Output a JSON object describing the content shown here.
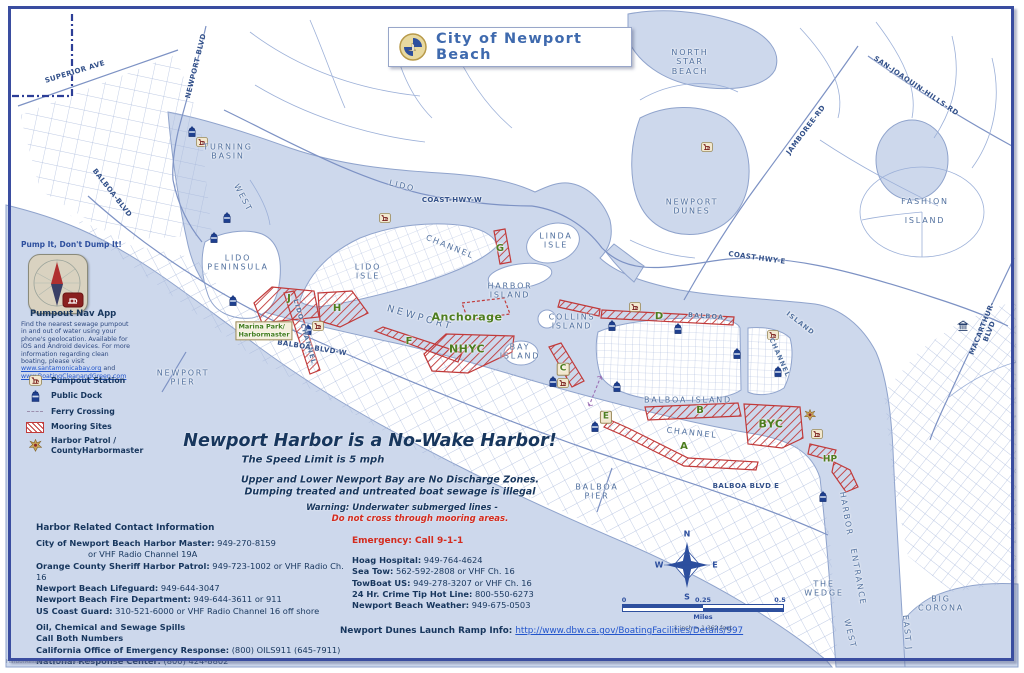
{
  "title": {
    "text": "City of Newport Beach"
  },
  "sidebar": {
    "slogan": "Pump It, Don't Dump It!",
    "app_name": "Pumpout Nav App",
    "desc": "Find the nearest sewage pumpout in and out of water using your phone's geolocation. Available for iOS and Android devices. For more information regarding clean boating, please visit",
    "link1": "www.santamonicabay.org",
    "conj": " and ",
    "link2": "www.BoatingCleanandGreen.com"
  },
  "legend": {
    "items": [
      {
        "icon": "pumpout",
        "label": "Pumpout Station"
      },
      {
        "icon": "dock",
        "label": "Public Dock"
      },
      {
        "icon": "ferry",
        "label": "Ferry Crossing"
      },
      {
        "icon": "mooring",
        "label": "Mooring Sites"
      },
      {
        "icon": "star",
        "label": "Harbor Patrol /\nCountyHarbormaster"
      }
    ]
  },
  "notices": {
    "main": "Newport Harbor is a No-Wake Harbor!",
    "speed": "The Speed Limit is 5 mph",
    "discharge1": "Upper and Lower Newport Bay are No Discharge Zones.",
    "discharge2": "Dumping treated and untreated boat sewage is illegal",
    "warning1": "Warning: Underwater submerged lines -",
    "warning2": "Do not cross through mooring areas."
  },
  "contacts": {
    "heading": "Harbor Related Contact Information",
    "lines": [
      {
        "b": "City of Newport Beach Harbor Master:",
        "t": " 949-270-8159"
      },
      {
        "t": "or VHF Radio Channel 19A",
        "indent": true
      },
      {
        "b": "Orange County Sheriff Harbor Patrol:",
        "t": " 949-723-1002 or VHF Radio Ch. 16"
      },
      {
        "b": "Newport Beach Lifeguard:",
        "t": " 949-644-3047"
      },
      {
        "b": "Newport Beach Fire Department:",
        "t": " 949-644-3611 or 911"
      },
      {
        "b": "US Coast Guard:",
        "t": " 310-521-6000 or VHF Radio Channel 16 off shore"
      },
      {
        "b": "Oil, Chemical and Sewage Spills",
        "gap": true
      },
      {
        "b": "Call Both Numbers"
      },
      {
        "b": "California Office of Emergency Response:",
        "t": " (800) OILS911 (645-7911)"
      },
      {
        "b": "National Response Center:",
        "t": " (800) 424-8802"
      }
    ]
  },
  "emergency": {
    "heading_label": "Emergency:",
    "heading_value": " Call 9-1-1",
    "lines": [
      {
        "b": "Hoag Hospital:",
        "t": " 949-764-4624"
      },
      {
        "b": "Sea Tow:",
        "t": " 562-592-2808 or VHF Ch. 16"
      },
      {
        "b": "TowBoat US:",
        "t": " 949-278-3207 or VHF Ch. 16"
      },
      {
        "b": "24 Hr. Crime Tip Hot Line:",
        "t": " 800-550-6273"
      },
      {
        "b": "Newport Beach Weather:",
        "t": " 949-675-0503"
      }
    ]
  },
  "launch": {
    "label": "Newport Dunes Launch Ramp Info: ",
    "url": "http://www.dbw.ca.gov/BoatingFacilities/Details/997"
  },
  "compass": {
    "n": "N",
    "w": "W",
    "e": "E",
    "s": "S"
  },
  "scale": {
    "t0": "0",
    "t1": "0.25",
    "t2": "0.5",
    "unit": "Miles",
    "note": "1 inch = 1,362 feet"
  },
  "footer": {
    "text": "HarborResources_PubInfo2.mxd"
  },
  "colors": {
    "water": "#cdd8ec",
    "border": "#3a4da0",
    "mooring_red": "#c13a3a",
    "navy": "#17365d",
    "green": "#4d7d1f",
    "alert_red": "#d42b1e",
    "road": "#7d92c4"
  },
  "map": {
    "labels": [
      {
        "t": "SUPERIOR AVE",
        "x": 75,
        "y": 72,
        "r": -17,
        "c": "road"
      },
      {
        "t": "NEWPORT BLVD",
        "x": 196,
        "y": 66,
        "r": -76,
        "c": "road"
      },
      {
        "t": "BALBOA-BLVD",
        "x": 112,
        "y": 193,
        "r": 52,
        "c": "road"
      },
      {
        "t": "TURNING\nBASIN",
        "x": 228,
        "y": 152,
        "r": 0,
        "c": "place"
      },
      {
        "t": "WEST",
        "x": 243,
        "y": 198,
        "r": 62,
        "c": "place"
      },
      {
        "t": "LIDO",
        "x": 402,
        "y": 186,
        "r": 14,
        "c": "place"
      },
      {
        "t": "CHANNEL",
        "x": 450,
        "y": 247,
        "r": 22,
        "c": "place"
      },
      {
        "t": "LIDO\nPENINSULA",
        "x": 238,
        "y": 263,
        "r": 0,
        "c": "place"
      },
      {
        "t": "LIDO\nISLE",
        "x": 368,
        "y": 272,
        "r": 0,
        "c": "place"
      },
      {
        "t": "LIDO CHANNEL",
        "x": 304,
        "y": 332,
        "r": 74,
        "c": "place-sm"
      },
      {
        "t": "COAST-HWY-W",
        "x": 452,
        "y": 200,
        "r": 0,
        "c": "road"
      },
      {
        "t": "LINDA\nISLE",
        "x": 556,
        "y": 241,
        "r": 0,
        "c": "place"
      },
      {
        "t": "HARBOR\nISLAND",
        "x": 510,
        "y": 291,
        "r": 0,
        "c": "place"
      },
      {
        "t": "NEWPORT",
        "x": 420,
        "y": 318,
        "r": 16,
        "c": "place-lg"
      },
      {
        "t": "BAY\nISLAND",
        "x": 520,
        "y": 352,
        "r": 0,
        "c": "place"
      },
      {
        "t": "COLLINS\nISLAND",
        "x": 572,
        "y": 322,
        "r": 0,
        "c": "place"
      },
      {
        "t": "NORTH\nSTAR\nBEACH",
        "x": 690,
        "y": 62,
        "r": 0,
        "c": "place"
      },
      {
        "t": "NEWPORT\nDUNES",
        "x": 692,
        "y": 207,
        "r": 0,
        "c": "place"
      },
      {
        "t": "SAN-JOAQUIN-HILLS-RD",
        "x": 916,
        "y": 86,
        "r": 34,
        "c": "road"
      },
      {
        "t": "JAMBOREE-RD",
        "x": 806,
        "y": 130,
        "r": -53,
        "c": "road"
      },
      {
        "t": "FASHION\n\nISLAND",
        "x": 925,
        "y": 211,
        "r": 0,
        "c": "place"
      },
      {
        "t": "COAST-HWY-E",
        "x": 757,
        "y": 258,
        "r": 8,
        "c": "road"
      },
      {
        "t": "MACARTHUR-BLVD",
        "x": 986,
        "y": 330,
        "r": -68,
        "c": "road"
      },
      {
        "t": "BALBOA",
        "x": 706,
        "y": 317,
        "r": 4,
        "c": "place-sm"
      },
      {
        "t": "ISLAND",
        "x": 800,
        "y": 324,
        "r": 38,
        "c": "place-sm"
      },
      {
        "t": "CHANNEL",
        "x": 779,
        "y": 358,
        "r": 66,
        "c": "place-sm"
      },
      {
        "t": "BALBOA ISLAND",
        "x": 688,
        "y": 400,
        "r": 0,
        "c": "place"
      },
      {
        "t": "CHANNEL",
        "x": 692,
        "y": 433,
        "r": 6,
        "c": "place"
      },
      {
        "t": "BALBOA\nPIER",
        "x": 597,
        "y": 492,
        "r": 0,
        "c": "place"
      },
      {
        "t": "BALBOA BLVD E",
        "x": 746,
        "y": 486,
        "r": 0,
        "c": "road"
      },
      {
        "t": "HARBOR",
        "x": 846,
        "y": 514,
        "r": 80,
        "c": "place"
      },
      {
        "t": "ENTRANCE",
        "x": 858,
        "y": 577,
        "r": 80,
        "c": "place"
      },
      {
        "t": "THE\nWEDGE",
        "x": 824,
        "y": 589,
        "r": 0,
        "c": "place"
      },
      {
        "t": "BIG\nCORONA",
        "x": 941,
        "y": 604,
        "r": 0,
        "c": "place"
      },
      {
        "t": "WEST",
        "x": 850,
        "y": 634,
        "r": 76,
        "c": "place"
      },
      {
        "t": "EAST J",
        "x": 907,
        "y": 633,
        "r": 84,
        "c": "place"
      },
      {
        "t": "NEWPORT\nPIER",
        "x": 183,
        "y": 378,
        "r": 0,
        "c": "place"
      },
      {
        "t": "BALBOA-BLVD-W",
        "x": 312,
        "y": 348,
        "r": 9,
        "c": "road"
      },
      {
        "t": "Marina Park/\nHarbormaster",
        "x": 264,
        "y": 331,
        "r": 0,
        "c": "green-box"
      },
      {
        "t": "Anchorage",
        "x": 467,
        "y": 318,
        "r": 0,
        "c": "green-lg"
      },
      {
        "t": "NHYC",
        "x": 467,
        "y": 350,
        "r": 0,
        "c": "green-lg"
      },
      {
        "t": "BYC",
        "x": 771,
        "y": 425,
        "r": 0,
        "c": "green-lg"
      },
      {
        "t": "HP",
        "x": 830,
        "y": 460,
        "r": 0,
        "c": "green"
      },
      {
        "t": "G",
        "x": 500,
        "y": 249,
        "r": 0,
        "c": "letter"
      },
      {
        "t": "J",
        "x": 289,
        "y": 299,
        "r": 0,
        "c": "letter"
      },
      {
        "t": "H",
        "x": 337,
        "y": 309,
        "r": 0,
        "c": "letter"
      },
      {
        "t": "F",
        "x": 409,
        "y": 342,
        "r": 0,
        "c": "letter"
      },
      {
        "t": "C",
        "x": 563,
        "y": 369,
        "r": 0,
        "c": "letter-box"
      },
      {
        "t": "D",
        "x": 659,
        "y": 317,
        "r": 0,
        "c": "letter"
      },
      {
        "t": "B",
        "x": 700,
        "y": 411,
        "r": 0,
        "c": "letter"
      },
      {
        "t": "A",
        "x": 684,
        "y": 447,
        "r": 0,
        "c": "letter"
      },
      {
        "t": "E",
        "x": 606,
        "y": 417,
        "r": 0,
        "c": "letter-box"
      }
    ],
    "icons": [
      {
        "t": "pumpout",
        "x": 202,
        "y": 142
      },
      {
        "t": "pumpout",
        "x": 385,
        "y": 218
      },
      {
        "t": "pumpout",
        "x": 318,
        "y": 326
      },
      {
        "t": "pumpout",
        "x": 635,
        "y": 307
      },
      {
        "t": "pumpout",
        "x": 773,
        "y": 335
      },
      {
        "t": "pumpout",
        "x": 563,
        "y": 383
      },
      {
        "t": "pumpout",
        "x": 707,
        "y": 147
      },
      {
        "t": "pumpout",
        "x": 817,
        "y": 434
      },
      {
        "t": "dock",
        "x": 192,
        "y": 132
      },
      {
        "t": "dock",
        "x": 227,
        "y": 218
      },
      {
        "t": "dock",
        "x": 214,
        "y": 238
      },
      {
        "t": "dock",
        "x": 233,
        "y": 301
      },
      {
        "t": "dock",
        "x": 308,
        "y": 330
      },
      {
        "t": "dock",
        "x": 612,
        "y": 326
      },
      {
        "t": "dock",
        "x": 678,
        "y": 329
      },
      {
        "t": "dock",
        "x": 737,
        "y": 354
      },
      {
        "t": "dock",
        "x": 778,
        "y": 372
      },
      {
        "t": "dock",
        "x": 617,
        "y": 387
      },
      {
        "t": "dock",
        "x": 595,
        "y": 427
      },
      {
        "t": "dock",
        "x": 823,
        "y": 497
      },
      {
        "t": "dock",
        "x": 553,
        "y": 382
      },
      {
        "t": "patrol",
        "x": 810,
        "y": 415
      },
      {
        "t": "bldg",
        "x": 963,
        "y": 326
      }
    ]
  }
}
